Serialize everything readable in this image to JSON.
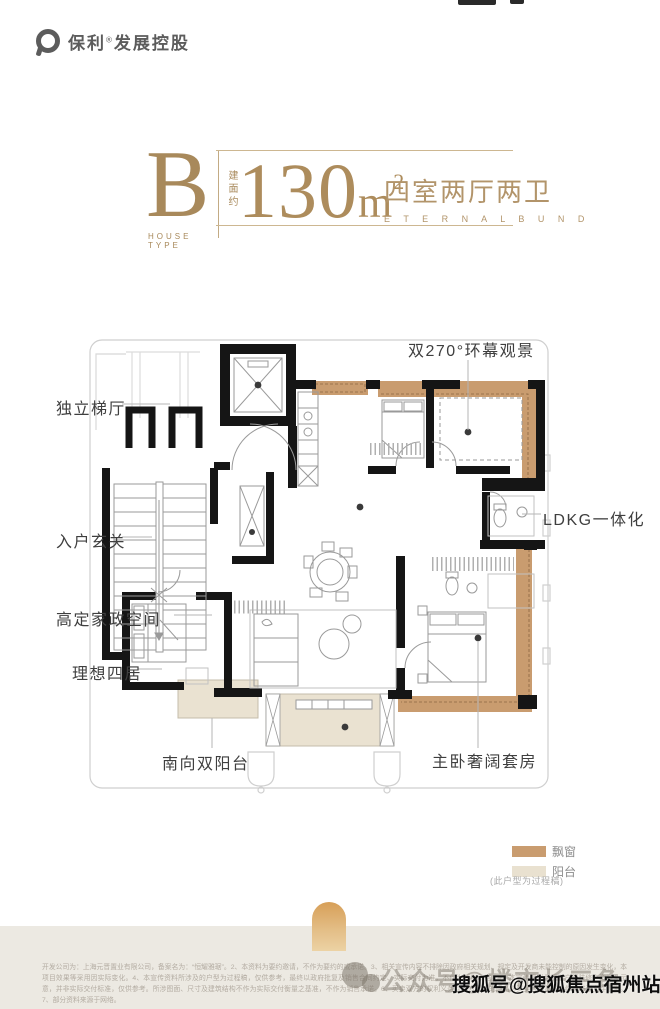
{
  "brand": {
    "name": "保利",
    "reg": "®",
    "suffix": "发展控股"
  },
  "title": {
    "type_letter": "B",
    "type_caption": "HOUSE TYPE",
    "area_prefix": "建面约",
    "area_value": "130",
    "area_unit": "m",
    "area_sup": "2",
    "layout_cn": "四室两厅两卫",
    "layout_en": "E T E R N A L   B U N D"
  },
  "plan": {
    "callouts": [
      {
        "label": "双270°环幕观景"
      },
      {
        "label": "独立梯厅"
      },
      {
        "label": "入户玄关"
      },
      {
        "label": "高定家政空间"
      },
      {
        "label": "理想四居"
      },
      {
        "label": "南向双阳台"
      },
      {
        "label": "主卧奢阔套房"
      },
      {
        "label": "LDKG一体化"
      }
    ],
    "legend": [
      {
        "label": "飘窗",
        "color": "#c99c6f"
      },
      {
        "label": "阳台",
        "color": "#e9e1d0"
      }
    ],
    "legend_note": "(此户型为过程稿)"
  },
  "footer": {
    "disclaimer": "开发公司为：上海元晋置业有限公司，备案名为：“恒耀雅琚”。2、本资料为要约邀请，不作为要约的或承诺。3、相关宣传内容不排除因政府相关规划、规定及开发商未能控制的原因发生变化，本项目效果等采用因实际变化。4、本宣传资料所涉及的户型为过程稿，仅供参考，最终以政府批复及销售合同约定、实际交付为准，不作为销售承诺。5、本宣传资料为模拟户型装修之资料及示意，并非实际交付标准，仅供参考。所涉图面、尺寸及建筑结构不作为实际交付衡量之基准，不作为销售承诺。6、买卖双方的权利义务以双方签订的商品房买卖合同及其附件等书面文件为准。7、部分资料来源于网络。",
    "watermark_faint": "公众号@楼市长三角",
    "watermark_bold": "搜狐号@搜狐焦点宿州站"
  },
  "colors": {
    "accent_gold": "#a8895b",
    "bay_window": "#c99c6f",
    "balcony": "#e9e1d0",
    "wall": "#151515",
    "footer_band": "#ece9e2"
  }
}
